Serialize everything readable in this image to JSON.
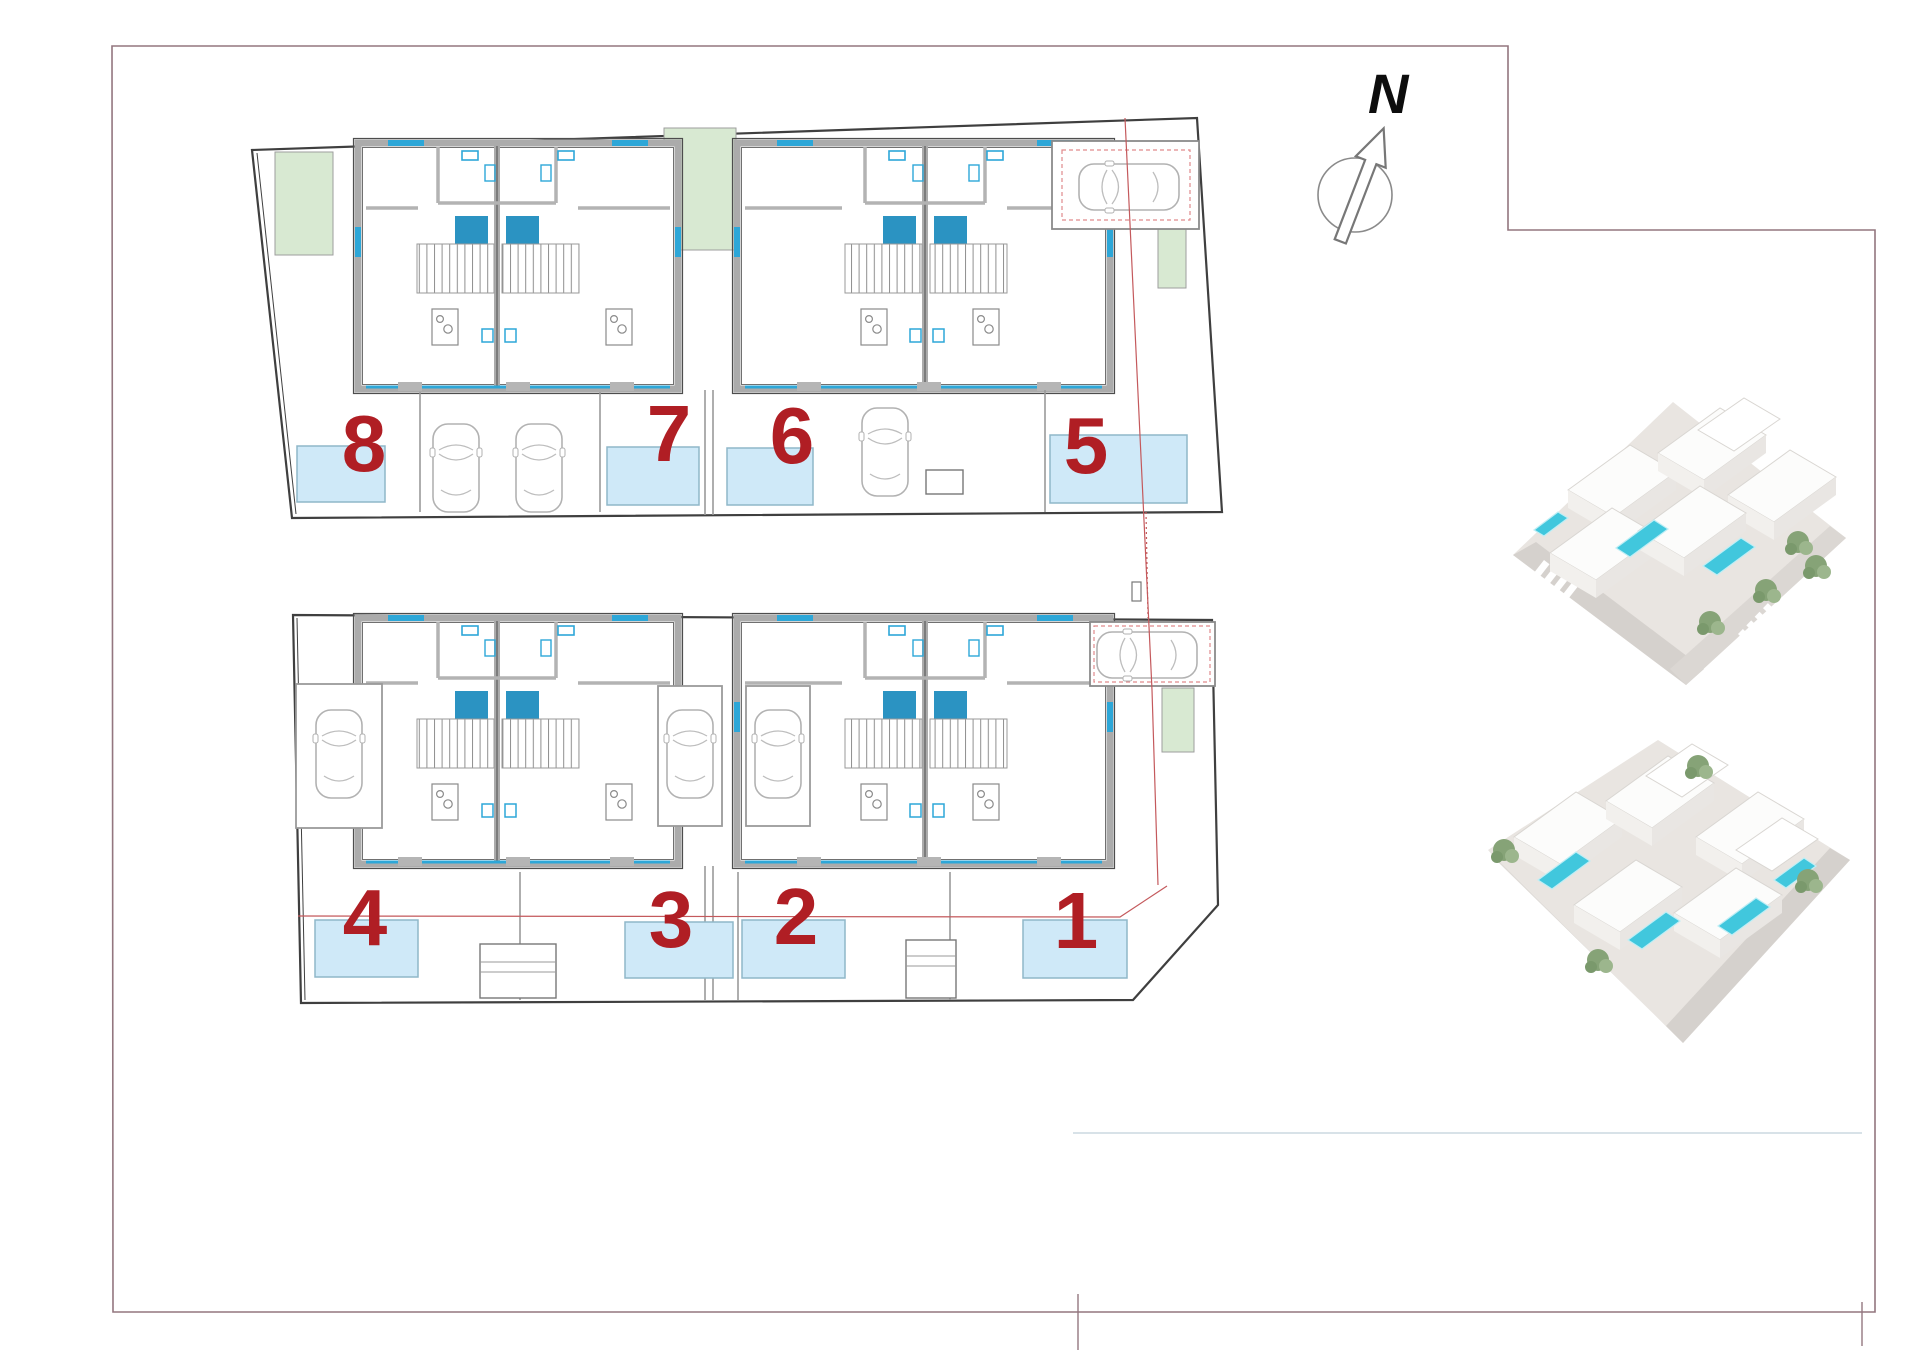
{
  "compass": {
    "label": "N"
  },
  "units": [
    {
      "number": "1"
    },
    {
      "number": "2"
    },
    {
      "number": "3"
    },
    {
      "number": "4"
    },
    {
      "number": "5"
    },
    {
      "number": "6"
    },
    {
      "number": "7"
    },
    {
      "number": "8"
    }
  ],
  "colors": {
    "unit_number_red": "#b01e24",
    "pool_fill": "#cfe9f8",
    "pool_border": "#8fb7c9",
    "stair_landing_teal": "#2b93c2",
    "garden_green": "#d8e9d2",
    "fixture_cyan": "#2da7d8",
    "wall_gray": "#ababab",
    "boundary_red": "#c4595c",
    "frame_mauve": "#93767f",
    "render_water_turquoise": "#41c7dd"
  }
}
